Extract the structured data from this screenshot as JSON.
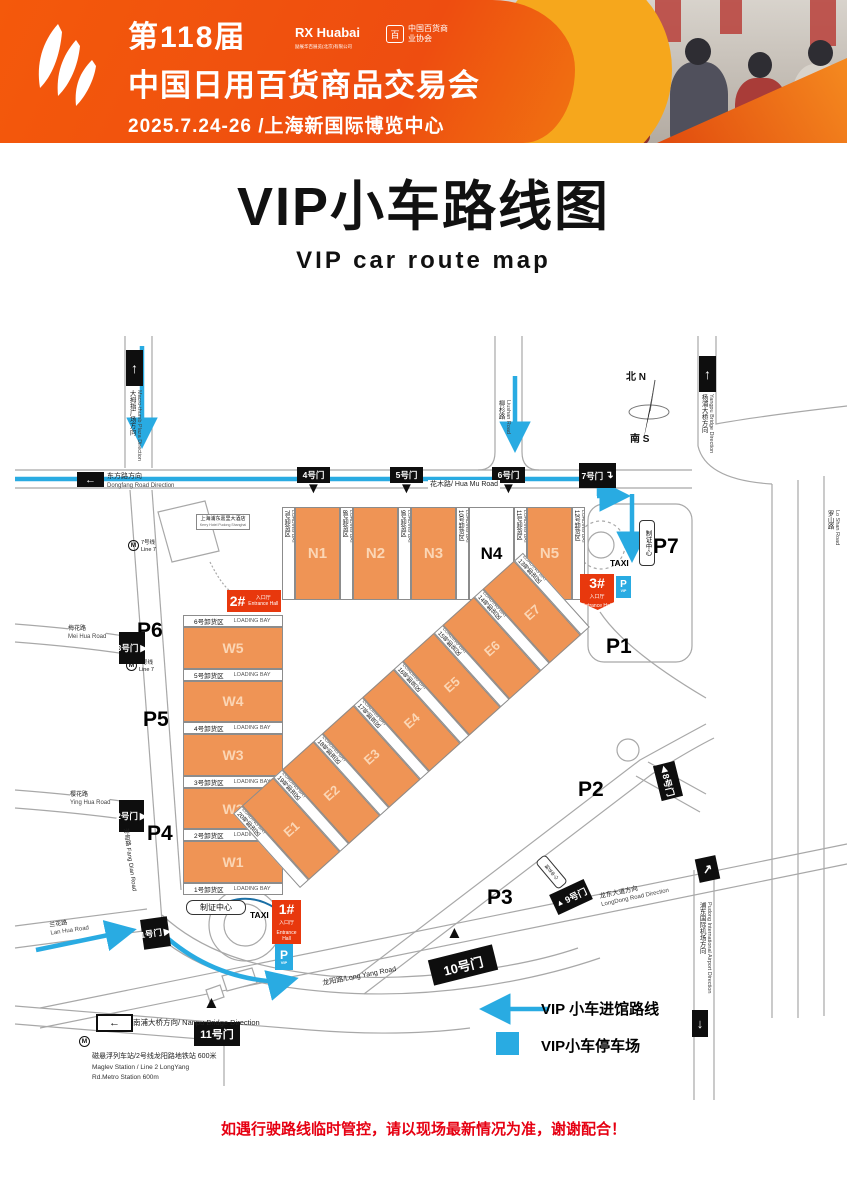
{
  "header": {
    "edition": "第118届",
    "title": "中国日用百货商品交易会",
    "date_venue": "2025.7.24-26 /上海新国际博览中心",
    "logo1": "RX Huabai",
    "logo1_sub": "励展华百展览(北京)有限公司",
    "logo2_mark": "百",
    "logo2": "中国百货商业协会"
  },
  "page_title": {
    "zh": "VIP小车路线图",
    "en": "VIP  car  route map"
  },
  "legend": {
    "route": "VIP 小车进馆路线",
    "parking": "VIP小车停车场"
  },
  "footer": {
    "notice": "如遇行驶路线临时管控，请以现场最新情况为准，谢谢配合！"
  },
  "colors": {
    "route_blue": "#29ABE2",
    "hall_orange": "#EF9455",
    "entrance_red": "#E8380D",
    "header_orange": "#F2570A",
    "notice_red": "#E60012"
  },
  "icons": {
    "arrow_up": "↑",
    "arrow_down": "↓",
    "arrow_left": "←",
    "arrow_ne": "↗",
    "arrow_turn": "↴",
    "tri_up": "▲",
    "tri_down": "▼",
    "tri_right": "▶",
    "tri_left": "◀",
    "metro": "M",
    "parking": "P",
    "vip": "VIP"
  },
  "map": {
    "compass": {
      "north": "北 N",
      "south": "南 S"
    },
    "halls": {
      "n": [
        "N1",
        "N2",
        "N3",
        "N4",
        "N5"
      ],
      "w": [
        "W5",
        "W4",
        "W3",
        "W2",
        "W1"
      ],
      "e": [
        "E1",
        "E2",
        "E3",
        "E4",
        "E5",
        "E6",
        "E7"
      ]
    },
    "n_bays": [
      "7号卸货区",
      "8号卸货区",
      "9号卸货区",
      "10号卸货区",
      "11号卸货区",
      "12号卸货区"
    ],
    "w_bays": [
      "6号卸货区",
      "5号卸货区",
      "4号卸货区",
      "3号卸货区",
      "2号卸货区",
      "1号卸货区"
    ],
    "e_bays": [
      "20号卸货区",
      "19号卸货区",
      "18号卸货区",
      "17号卸货区",
      "16号卸货区",
      "15号卸货区",
      "14号卸货区",
      "13号卸货区"
    ],
    "loading_bay_en": "LOADING BAY",
    "parking": [
      "P1",
      "P2",
      "P3",
      "P4",
      "P5",
      "P6",
      "P7"
    ],
    "gates": [
      "1号门",
      "2号门",
      "3号门",
      "4号门",
      "5号门",
      "6号门",
      "7号门",
      "8号门",
      "9号门",
      "10号门",
      "11号门"
    ],
    "entrances": {
      "nums": [
        "1#",
        "2#",
        "3#"
      ],
      "zh": "入口厅",
      "en": "Entrance Hall"
    },
    "taxi": "TAXI",
    "cert_center": "制证中心",
    "metro": {
      "zh": "7号线",
      "en": "Line 7"
    },
    "hotel": {
      "zh": "上海浦东嘉里大酒店",
      "en": "Kerry Hotel Pudong Shanghai"
    },
    "roads": {
      "thumb_zh": "大拇指广场方向",
      "thumb_en": "Macro-thumb Plaza Direction",
      "dongfang_zh": "东方路方向",
      "dongfang_en": "Dongfang Road Direction",
      "huamu": "花木路/ Hua Mu Road",
      "liushan_zh": "柳杉路",
      "liushan_en": "Liushan Road",
      "yangpu_zh": "杨浦大桥方向",
      "yangpu_en": "Yangpu Bridge Direction",
      "loshan_zh": "罗山路",
      "loshan_en": "Lo Shan Road",
      "fangdian": "芳甸路 Fang Dian Road",
      "meihua_zh": "梅花路",
      "meihua_en": "Mei Hua Road",
      "yinghua_zh": "樱花路",
      "yinghua_en": "Ying Hua Road",
      "lanhua_zh": "兰花路",
      "lanhua_en": "Lan Hua Road",
      "nanpu": "南浦大桥方向/ Nanpu Bridge Direction",
      "longyang": "龙阳路/Long Yang Road",
      "longdong_zh": "龙东大道方向",
      "longdong_en": "LongDong Road Direction",
      "airport_zh": "浦东国际机场方向",
      "airport_en": "Pudong International Airport Direction"
    },
    "maglev": {
      "zh": "磁悬浮列车站/2号线龙阳路地铁站  600米",
      "en1": "Maglev Station / Line 2 LongYang",
      "en2": "Rd.Metro Station 600m"
    }
  }
}
